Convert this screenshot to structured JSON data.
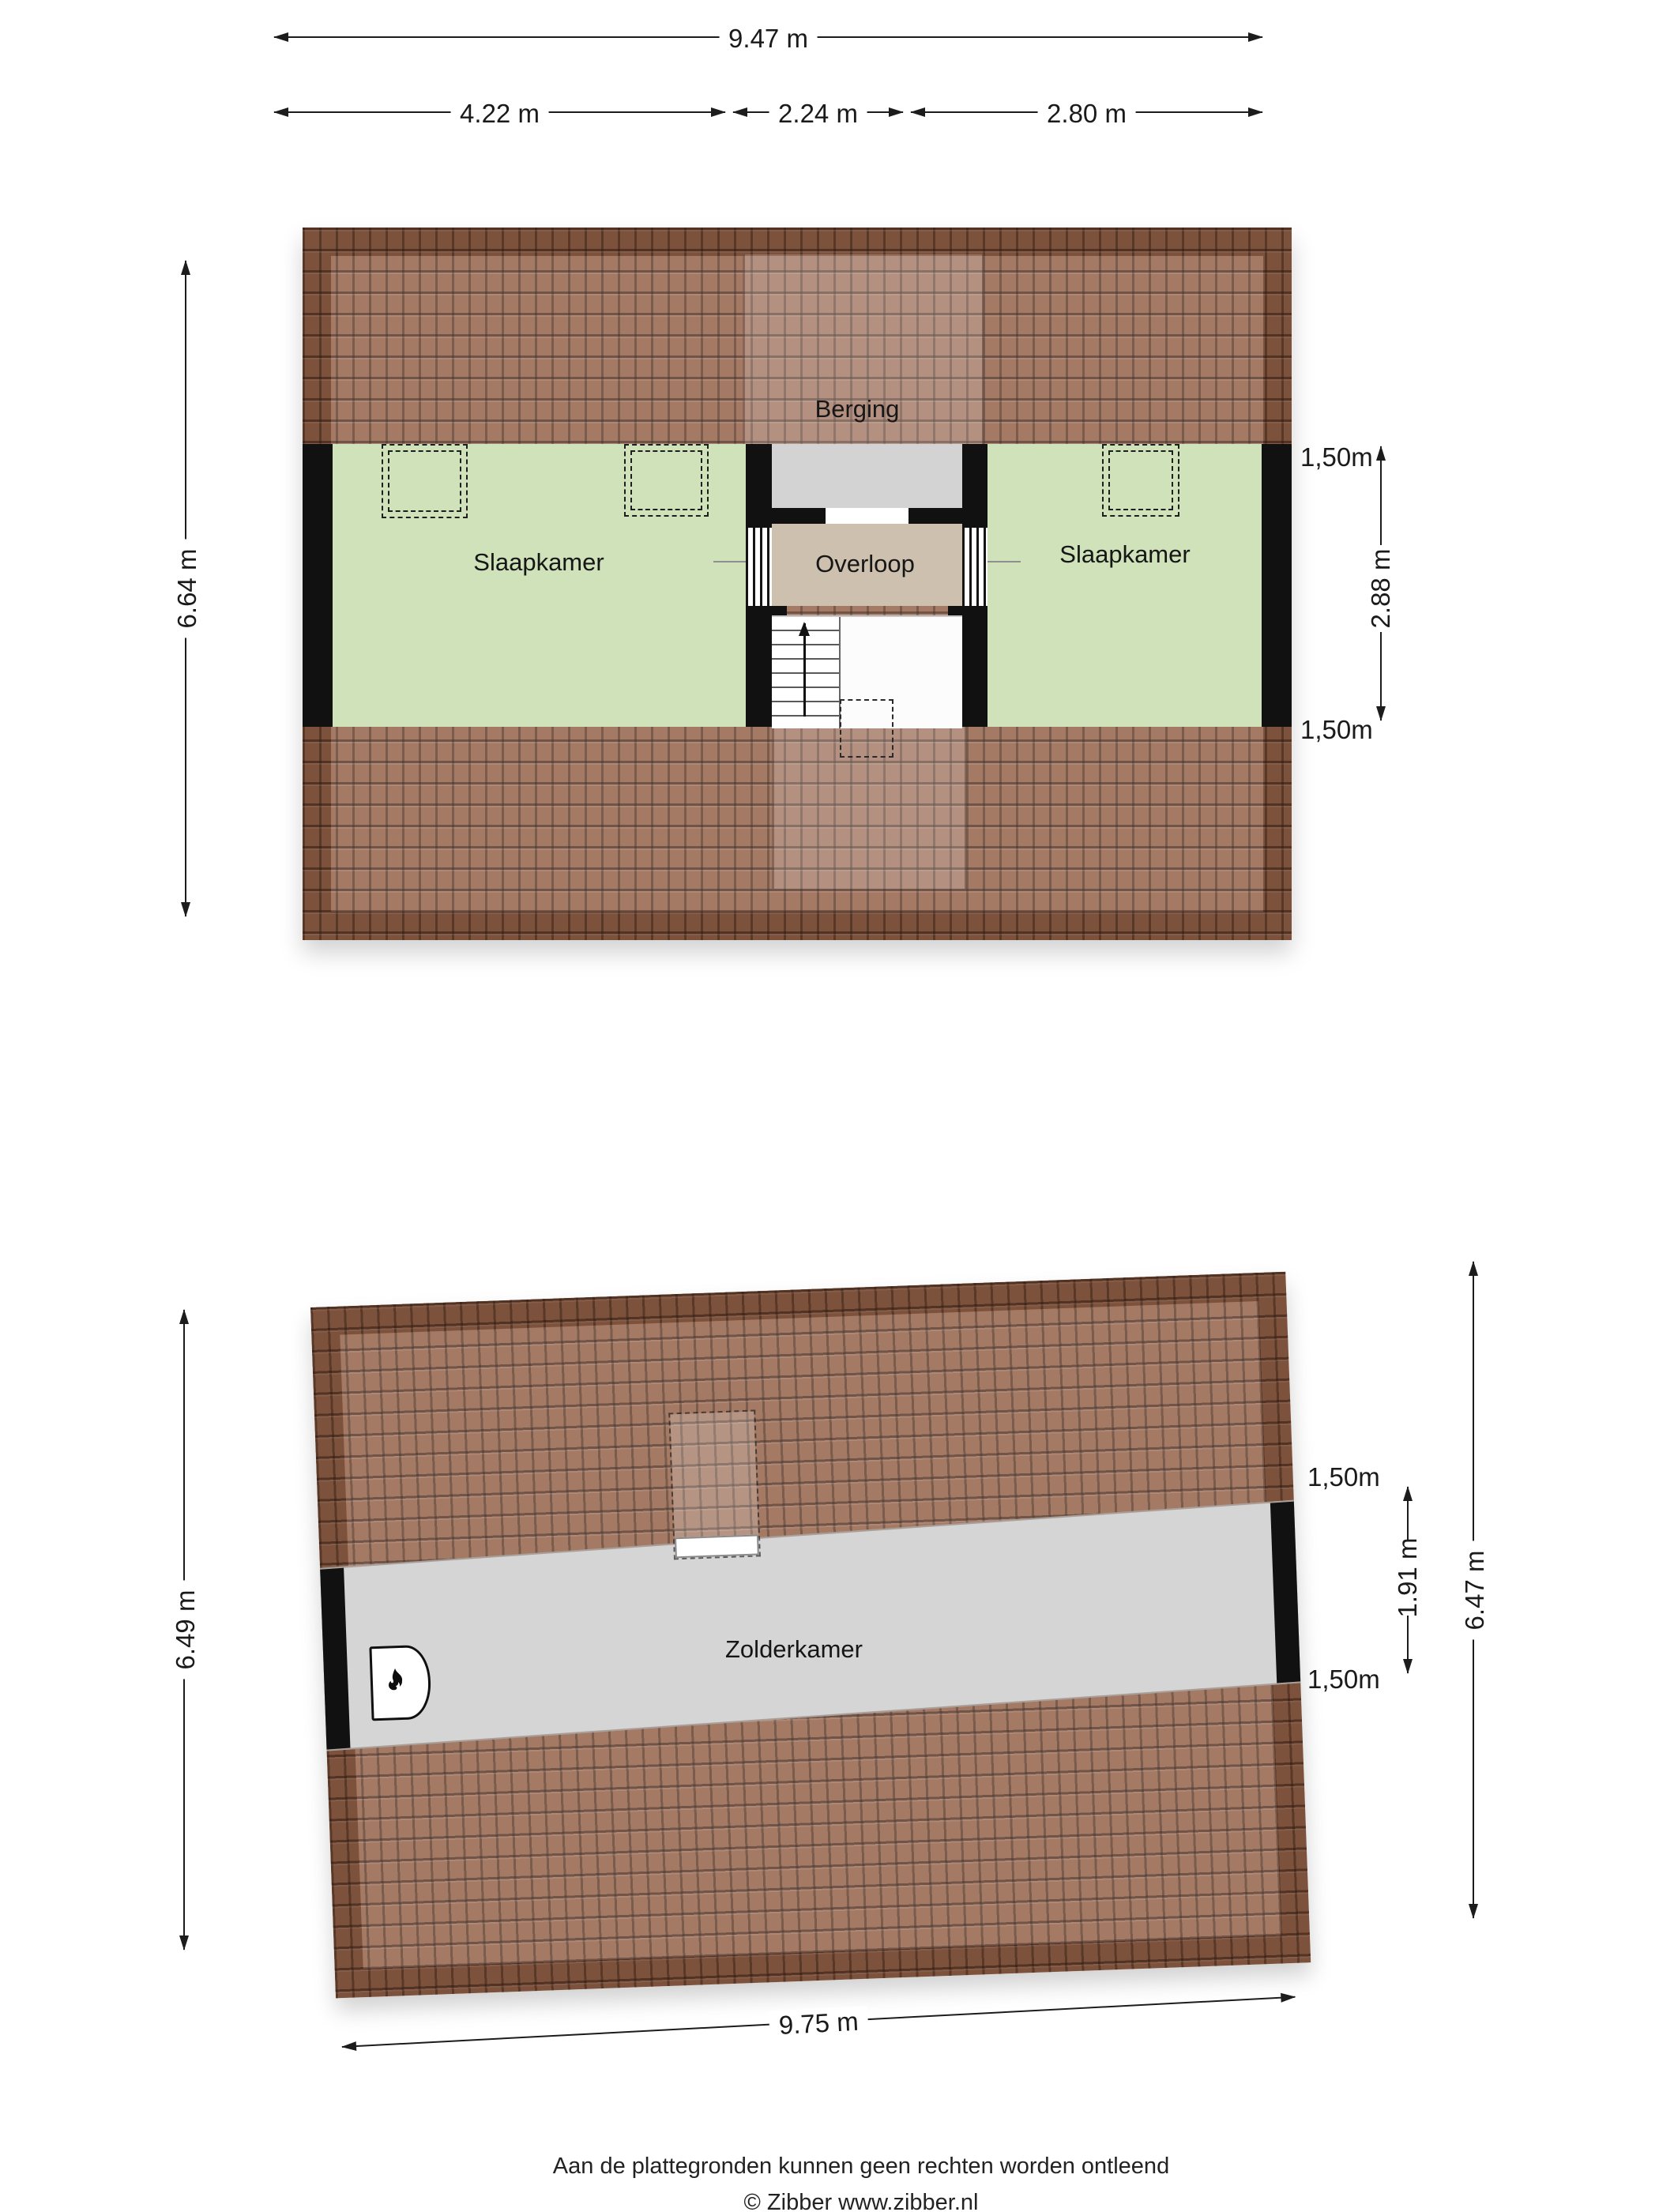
{
  "floor1": {
    "rooms": {
      "berging": "Berging",
      "slaapkamer_left": "Slaapkamer",
      "overloop": "Overloop",
      "slaapkamer_right": "Slaapkamer"
    },
    "dims": {
      "total_width": "9.47 m",
      "seg1": "4.22 m",
      "seg2": "2.24 m",
      "seg3": "2.80 m",
      "height_left": "6.64 m",
      "knee_top": "1,50m",
      "mid_height": "2.88 m",
      "knee_bottom": "1,50m"
    }
  },
  "floor2": {
    "rooms": {
      "zolderkamer": "Zolderkamer"
    },
    "dims": {
      "height_left": "6.49 m",
      "knee_top": "1,50m",
      "mid_height": "1.91 m",
      "knee_bottom": "1,50m",
      "height_right": "6.47 m",
      "total_width": "9.75 m"
    }
  },
  "footer": {
    "line1": "Aan de plattegronden kunnen geen rechten worden ontleend",
    "line2": "© Zibber www.zibber.nl"
  },
  "icons": {
    "fireplace": "fireplace-flame",
    "stairs_direction": "arrow-up"
  },
  "colors": {
    "roof_brown": "#97674f",
    "room_green": "#cfe2ba",
    "hall_beige": "#cec0ae",
    "storage_gray": "#d3d3d3",
    "wall_black": "#111111",
    "page_bg": "#ffffff"
  }
}
